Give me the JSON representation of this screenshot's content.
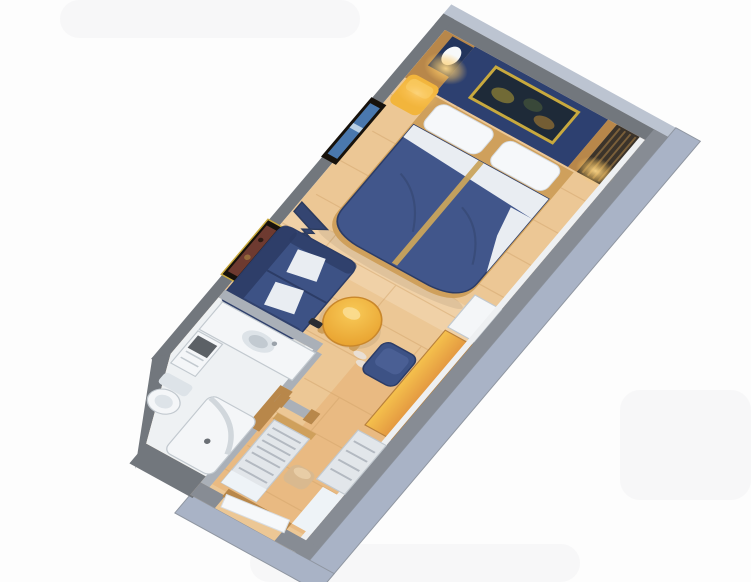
{
  "scene": {
    "kind": "isometric-3d-floorplan-render",
    "subject": "cruise-ship-stateroom-cutaway",
    "visible_text": [],
    "rooms": [
      {
        "name": "bedroom",
        "furniture": [
          "double-bed",
          "pillows",
          "navy-duvet",
          "gold-center-stripe",
          "yellow-nightstand",
          "wall-lamp",
          "headboard-accent-wall",
          "framed-art-headboard",
          "framed-art-left-wall",
          "wood-trim-columns",
          "wood-slat-alcove"
        ]
      },
      {
        "name": "sitting-area",
        "furniture": [
          "navy-loveseat",
          "white-throw-pillows",
          "framed-art-above-sofa",
          "round-yellow-coffee-table",
          "remote-on-floor",
          "slippers",
          "navy-privacy-curtain",
          "white-ledge",
          "yellow-desk",
          "navy-stool"
        ]
      },
      {
        "name": "bathroom",
        "furniture": [
          "sink-vanity",
          "mirror-cabinet",
          "toilet",
          "shower-with-curtain",
          "floor-drain"
        ]
      },
      {
        "name": "entry-corridor",
        "furniture": [
          "wardrobe-with-shelves",
          "storage-unit",
          "woven-basket",
          "mirror-panel",
          "entry-door",
          "wood-thresholds"
        ]
      }
    ],
    "structure": [
      "gray-wall-tops",
      "blue-gray-exterior-wall-face",
      "chamfered-bathroom-corner",
      "wood-plank-flooring",
      "white-interior-walls"
    ]
  },
  "palette": {
    "bg": "#fdfdfd",
    "smudge": "#f2f2f4",
    "wall_dark": "#72777d",
    "wall_top": "#878c94",
    "wall_part": "#aab0b8",
    "wall_inner": "#eef0f2",
    "wall_face": "#a9b3c6",
    "wall_face_light": "#bcc4d1",
    "wall_edge": "#8f96a1",
    "floor_wood": "#ecc795",
    "floor_warm": "#e39a54",
    "floor_light": "#f6debc",
    "plank": "#d0a168",
    "bath_floor": "#eef1f3",
    "navy_wall": "#2d4070",
    "navy_bed": "#41568b",
    "navy_sofa": "#3d5285",
    "navy_dark": "#2c3c66",
    "wood_trim": "#b8874a",
    "wood_light": "#cfa05c",
    "wood_slat": "#8a6a3e",
    "gold": "#c9a45c",
    "yellow": "#f2b53c",
    "yellow_deep": "#e08f3e",
    "glow": "#ffd98a",
    "linen": "#f6f8fa",
    "linen2": "#e9edf2",
    "linen_shadow": "#d8dde2",
    "fixture": "#f4f6f8",
    "fixture_line": "#c2c9cf",
    "fixture_shadow": "#dde3e8",
    "frame_dark": "#17120c",
    "art_blue": "#4a78ae",
    "art_red": "#6e3a30",
    "alcove": "#3b332a",
    "closet": "#e2e6ea",
    "closet_line": "#a8aeb6",
    "mirror": "#eef3f7",
    "basket": "#d9b98f",
    "remote": "#2a2d33"
  }
}
